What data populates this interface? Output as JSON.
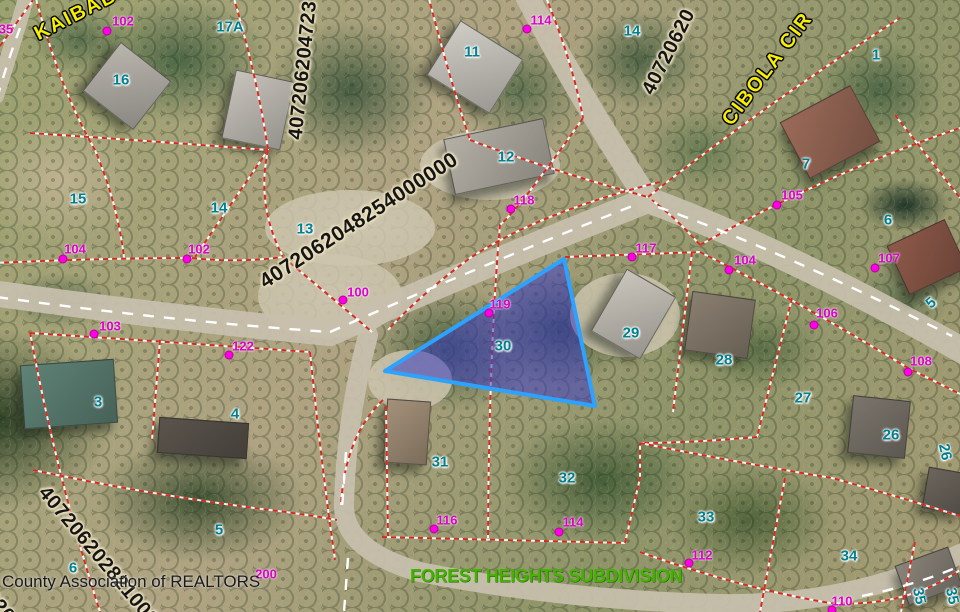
{
  "map": {
    "watermark": "County Association of REALTORS",
    "subdivision": {
      "label": "FOREST HEIGHTS SUBDIVISION",
      "color": "#44b300"
    },
    "streets": [
      {
        "name": "KAIBAB",
        "x": 36,
        "y": 24,
        "angle": -27
      },
      {
        "name": "CIBOLA CIR",
        "x": 727,
        "y": 112,
        "angle": -53
      }
    ],
    "parcel_ids": [
      {
        "label": "4072062048254000000",
        "x": 262,
        "y": 272,
        "angle": -33,
        "size": 21
      },
      {
        "label": "407206204723",
        "x": 296,
        "y": 128,
        "angle": -84,
        "size": 20
      },
      {
        "label": "40720620",
        "x": 648,
        "y": 82,
        "angle": -63,
        "size": 20
      },
      {
        "label": "407206202821000",
        "x": 42,
        "y": 478,
        "angle": 50,
        "size": 20
      },
      {
        "label": "020",
        "x": -12,
        "y": 582,
        "angle": 50,
        "size": 20
      }
    ],
    "lot_numbers": [
      {
        "label": "17A",
        "x": 230,
        "y": 27
      },
      {
        "label": "16",
        "x": 121,
        "y": 80
      },
      {
        "label": "11",
        "x": 472,
        "y": 52
      },
      {
        "label": "12",
        "x": 506,
        "y": 157
      },
      {
        "label": "14",
        "x": 632,
        "y": 31
      },
      {
        "label": "1",
        "x": 876,
        "y": 55
      },
      {
        "label": "7",
        "x": 806,
        "y": 164
      },
      {
        "label": "6",
        "x": 888,
        "y": 220
      },
      {
        "label": "5",
        "x": 931,
        "y": 303,
        "rot": -40
      },
      {
        "label": "15",
        "x": 78,
        "y": 199
      },
      {
        "label": "14",
        "x": 219,
        "y": 208
      },
      {
        "label": "13",
        "x": 305,
        "y": 229
      },
      {
        "label": "29",
        "x": 631,
        "y": 333
      },
      {
        "label": "28",
        "x": 724,
        "y": 360
      },
      {
        "label": "27",
        "x": 803,
        "y": 398
      },
      {
        "label": "26",
        "x": 891,
        "y": 435
      },
      {
        "label": "26",
        "x": 945,
        "y": 452,
        "rot": 78
      },
      {
        "label": "30",
        "x": 503,
        "y": 346
      },
      {
        "label": "3",
        "x": 98,
        "y": 402
      },
      {
        "label": "4",
        "x": 235,
        "y": 414
      },
      {
        "label": "31",
        "x": 440,
        "y": 462
      },
      {
        "label": "32",
        "x": 567,
        "y": 478
      },
      {
        "label": "33",
        "x": 706,
        "y": 517
      },
      {
        "label": "34",
        "x": 849,
        "y": 556
      },
      {
        "label": "5",
        "x": 219,
        "y": 530
      },
      {
        "label": "6",
        "x": 73,
        "y": 568
      },
      {
        "label": "35",
        "x": 919,
        "y": 596,
        "rot": 78
      },
      {
        "label": "35",
        "x": 952,
        "y": 596,
        "rot": 78
      }
    ],
    "address_markers": [
      {
        "label": "102",
        "tx": 123,
        "ty": 21,
        "dx": 107,
        "dy": 31
      },
      {
        "label": "114",
        "tx": 541,
        "ty": 20,
        "dx": 527,
        "dy": 29
      },
      {
        "label": "105",
        "tx": 792,
        "ty": 195,
        "dx": 777,
        "dy": 205
      },
      {
        "label": "117",
        "tx": 646,
        "ty": 248,
        "dx": 632,
        "dy": 257
      },
      {
        "label": "104",
        "tx": 745,
        "ty": 260,
        "dx": 729,
        "dy": 270
      },
      {
        "label": "107",
        "tx": 889,
        "ty": 258,
        "dx": 875,
        "dy": 268
      },
      {
        "label": "106",
        "tx": 827,
        "ty": 313,
        "dx": 814,
        "dy": 325
      },
      {
        "label": "108",
        "tx": 921,
        "ty": 361,
        "dx": 908,
        "dy": 372
      },
      {
        "label": "104",
        "tx": 75,
        "ty": 249,
        "dx": 63,
        "dy": 259
      },
      {
        "label": "102",
        "tx": 199,
        "ty": 249,
        "dx": 187,
        "dy": 259
      },
      {
        "label": "100",
        "tx": 358,
        "ty": 292,
        "dx": 343,
        "dy": 300
      },
      {
        "label": "103",
        "tx": 110,
        "ty": 326,
        "dx": 94,
        "dy": 334
      },
      {
        "label": "122",
        "tx": 243,
        "ty": 346,
        "dx": 229,
        "dy": 355
      },
      {
        "label": "118",
        "tx": 524,
        "ty": 200,
        "dx": 511,
        "dy": 209
      },
      {
        "label": "119",
        "tx": 500,
        "ty": 304,
        "dx": 489,
        "dy": 313
      },
      {
        "label": "116",
        "tx": 447,
        "ty": 520,
        "dx": 434,
        "dy": 529
      },
      {
        "label": "114",
        "tx": 573,
        "ty": 522,
        "dx": 559,
        "dy": 532
      },
      {
        "label": "112",
        "tx": 702,
        "ty": 555,
        "dx": 689,
        "dy": 563
      },
      {
        "label": "110",
        "tx": 842,
        "ty": 601,
        "dx": 832,
        "dy": 610
      },
      {
        "label": "200",
        "tx": 266,
        "ty": 574
      },
      {
        "label": "35",
        "tx": 6,
        "ty": 29
      }
    ],
    "highlight": {
      "lot": "30",
      "points": "564,259 595,406 385,371",
      "fill": "rgba(60,60,195,0.55)",
      "stroke": "#2da2ff"
    },
    "colors": {
      "lot_number": "#007f8e",
      "address_text": "#e000cc",
      "marker_dot": "#ff00e6",
      "parcel_line": "#d42b1e",
      "street_label": "#f8ef00",
      "parcel_id_text": "#151515",
      "road": "#c8c0ae"
    }
  }
}
